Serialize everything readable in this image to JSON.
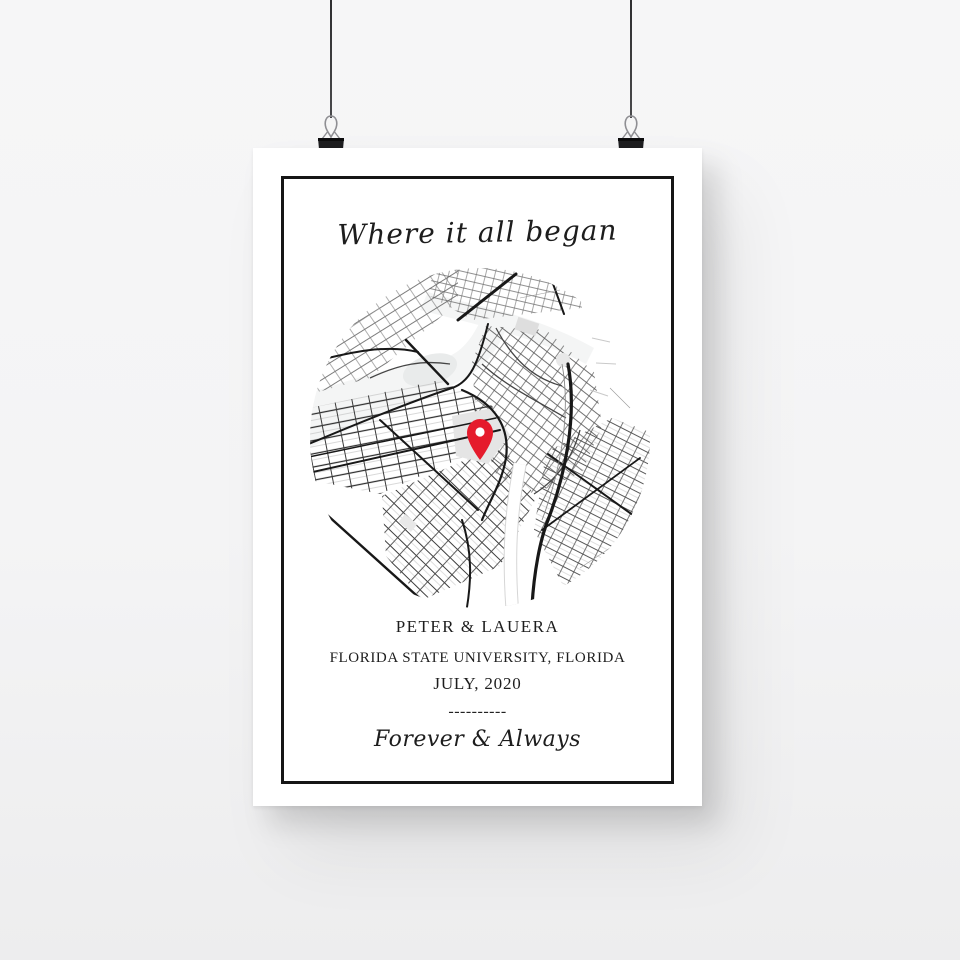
{
  "scene": {
    "background_color": "#f5f5f6",
    "string_color": "#3b3b3d",
    "clip_color": "#1e1e20"
  },
  "poster": {
    "title": "Where it all began",
    "names": "PETER & LAUERA",
    "location": "FLORIDA STATE UNIVERSITY, FLORIDA",
    "date": "JULY, 2020",
    "divider": "----------",
    "tagline": "Forever & Always",
    "frame_color": "#151515",
    "text_color": "#1d1d1d",
    "map": {
      "pin_color": "#e51b2c",
      "road_dark": "#181818",
      "road_mid": "#454545",
      "road_light": "#9a9a9a",
      "area_gray": "#e5e5e5",
      "water_tint": "#f4f5f5"
    }
  }
}
